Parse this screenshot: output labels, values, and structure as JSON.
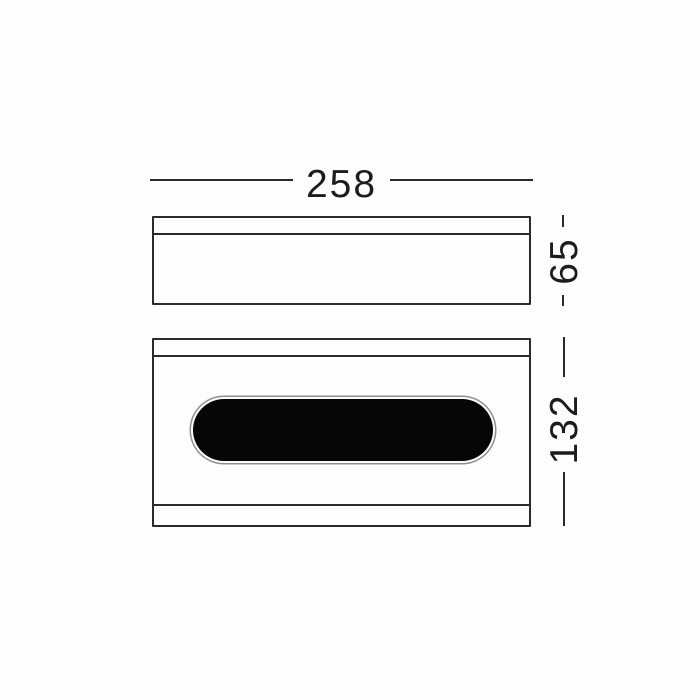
{
  "drawing": {
    "dimension_labels": {
      "width": "258",
      "depth": "65",
      "height": "132"
    },
    "colors": {
      "line": "#2a2a2a",
      "text": "#1c1c1c",
      "opening_fill": "#060606",
      "background": "#fdfdfd"
    }
  }
}
